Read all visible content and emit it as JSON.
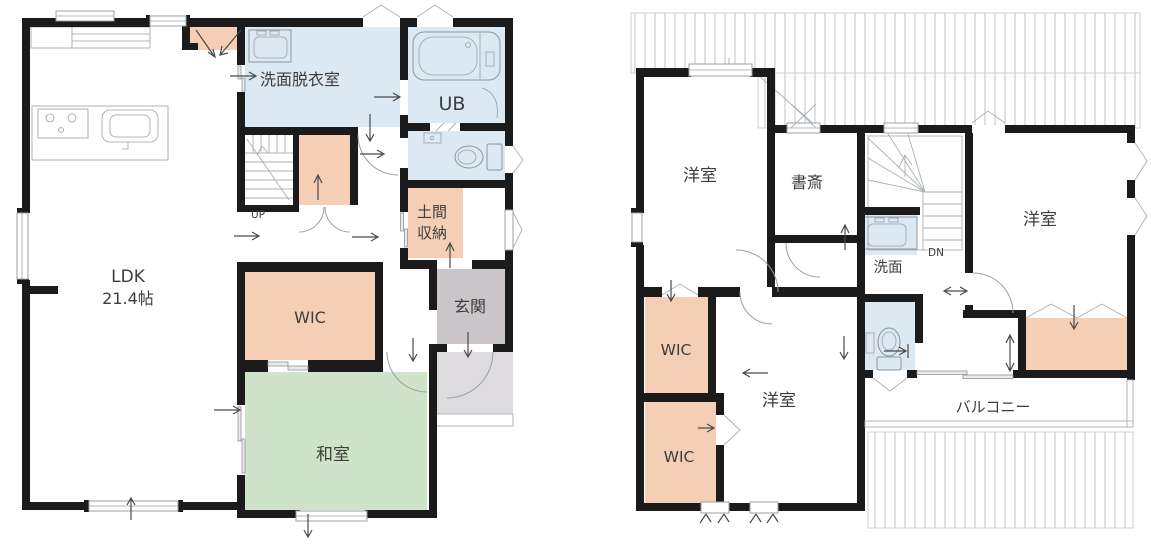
{
  "palette": {
    "wall": "#1b1b1b",
    "peach": "#f4cfb5",
    "blue": "#dce8f2",
    "green": "#cfe3ca",
    "gray": "#c9c5c8",
    "porch": "#dedbde",
    "line": "#8f959a",
    "roof": "#c0c4c7",
    "text": "#3d3d3d"
  },
  "floor1": {
    "rooms": {
      "ldk_line1": "LDK",
      "ldk_line2": "21.4帖",
      "washroom": "洗面脱衣室",
      "bath": "UB",
      "doma_line1": "土間",
      "doma_line2": "収納",
      "entrance": "玄関",
      "wic": "WIC",
      "tatami": "和室",
      "stairs": "UP"
    }
  },
  "floor2": {
    "rooms": {
      "bedroom_nw": "洋室",
      "study": "書斎",
      "washbasin": "洗面",
      "stairs": "DN",
      "bedroom_e": "洋室",
      "bedroom_s": "洋室",
      "wic_upper": "WIC",
      "wic_lower": "WIC",
      "balcony": "バルコニー"
    }
  }
}
